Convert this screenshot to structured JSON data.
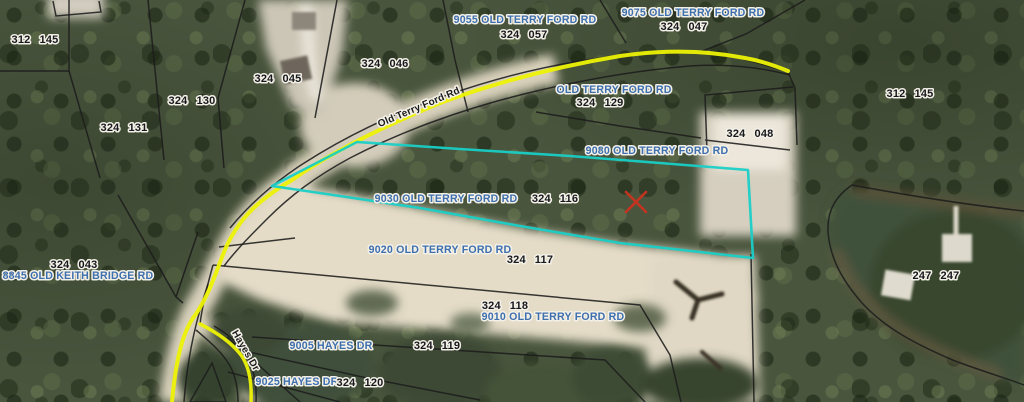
{
  "map": {
    "colors": {
      "address_text": "#3e6fae",
      "parcel_text": "#17181c",
      "road_text": "#1b1b1b",
      "parcel_highlight": "#19cfc6",
      "road_highlight": "#edf205",
      "marker": "#c23420"
    },
    "address_labels": [
      "9055 OLD TERRY FORD RD",
      "9075 OLD TERRY FORD RD",
      "OLD TERRY FORD RD",
      "9080 OLD TERRY FORD RD",
      "9030 OLD TERRY FORD RD",
      "9020 OLD TERRY FORD RD",
      "9010 OLD TERRY FORD RD",
      "8845 OLD KEITH BRIDGE RD",
      "9005 HAYES DR",
      "9025 HAYES DR"
    ],
    "parcel_ids": [
      {
        "book": "312",
        "page": "145"
      },
      {
        "book": "324",
        "page": "130"
      },
      {
        "book": "324",
        "page": "131"
      },
      {
        "book": "324",
        "page": "045"
      },
      {
        "book": "324",
        "page": "046"
      },
      {
        "book": "324",
        "page": "057"
      },
      {
        "book": "324",
        "page": "047"
      },
      {
        "book": "312",
        "page": "145"
      },
      {
        "book": "324",
        "page": "129"
      },
      {
        "book": "324",
        "page": "048"
      },
      {
        "book": "324",
        "page": "116"
      },
      {
        "book": "324",
        "page": "117"
      },
      {
        "book": "324",
        "page": "118"
      },
      {
        "book": "324",
        "page": "119"
      },
      {
        "book": "324",
        "page": "120"
      },
      {
        "book": "324",
        "page": "043"
      },
      {
        "book": "247",
        "page": "247"
      }
    ],
    "road_names": [
      "Old Terry Ford Rd",
      "Hayes Dr"
    ]
  }
}
